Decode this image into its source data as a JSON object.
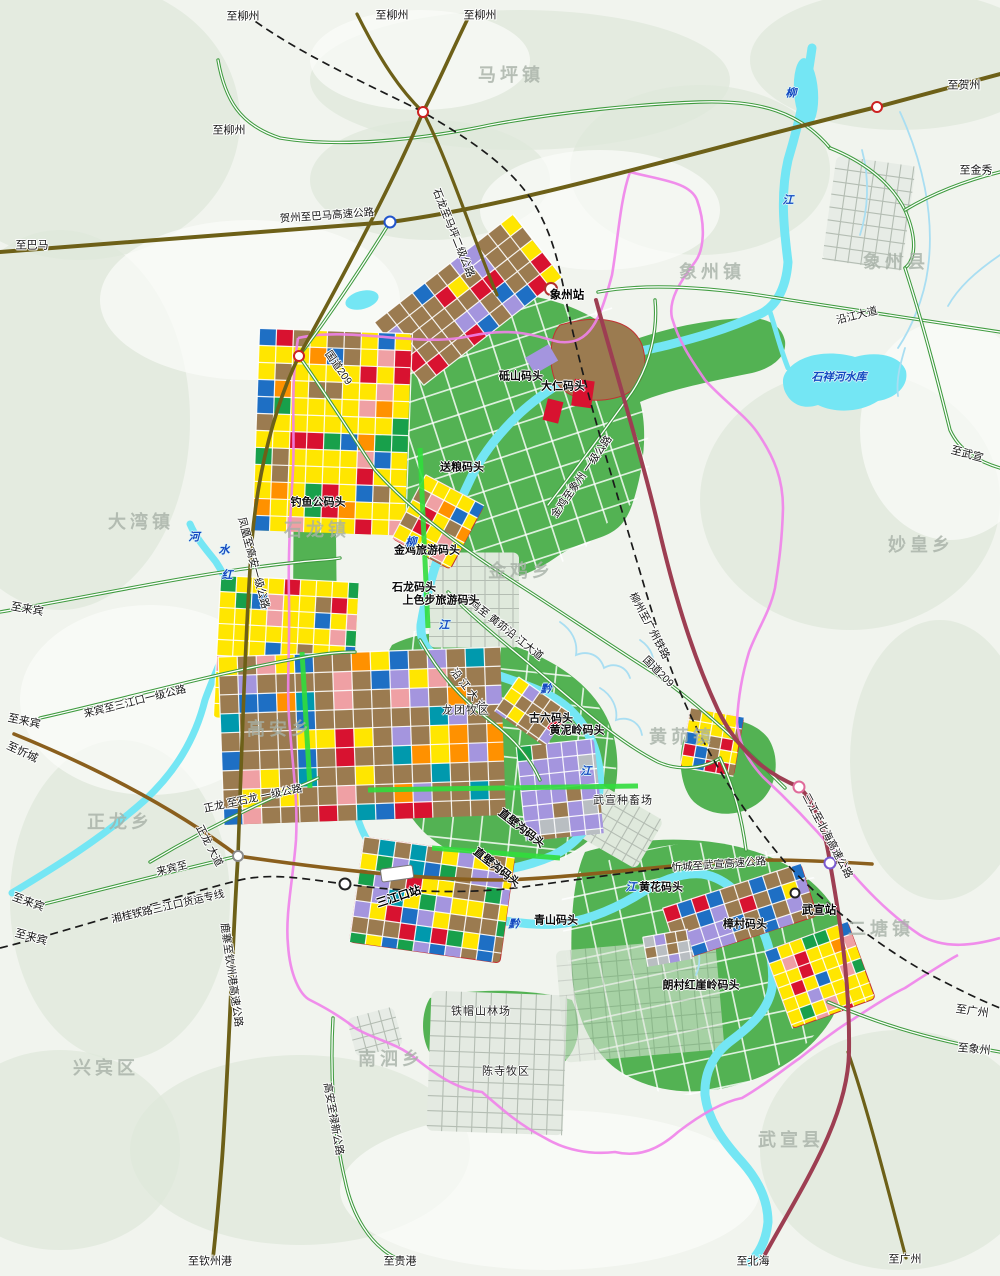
{
  "palette": {
    "background": "#f1f4ee",
    "terrain": "#dfe8db",
    "terrain_light": "#fbfcfa",
    "water": "#74e6f4",
    "water_light": "#a9def2",
    "green_zone": "#53b253",
    "bright_green": "#31dd3c",
    "road_primary": "#6d6018",
    "road_expressway": "#9d3e52",
    "road_brown": "#8a5f1d",
    "road_secondary": "#3f9b3f",
    "boundary": "#ef82ea",
    "railway": "#1a1a1a",
    "landuse": {
      "yellow": "#ffe600",
      "brown": "#9b7b50",
      "red": "#d81230",
      "pink": "#efa0a4",
      "orange": "#ff9100",
      "purple": "#a495de",
      "blue": "#1e6fc4",
      "teal": "#0099ad",
      "green": "#18a04b",
      "gray": "#b9bec2"
    }
  },
  "labels": {
    "destinations": [
      {
        "t": "至柳州",
        "x": 243,
        "y": 17,
        "r": 0
      },
      {
        "t": "至柳州",
        "x": 392,
        "y": 16,
        "r": 0
      },
      {
        "t": "至柳州",
        "x": 480,
        "y": 16,
        "r": 0
      },
      {
        "t": "至柳州",
        "x": 229,
        "y": 131,
        "r": 0
      },
      {
        "t": "至贺州",
        "x": 964,
        "y": 86,
        "r": 0
      },
      {
        "t": "至金秀",
        "x": 976,
        "y": 171,
        "r": 0
      },
      {
        "t": "至巴马",
        "x": 32,
        "y": 246,
        "r": 0
      },
      {
        "t": "至武宣",
        "x": 967,
        "y": 455,
        "r": 15
      },
      {
        "t": "至来宾",
        "x": 27,
        "y": 610,
        "r": 10
      },
      {
        "t": "至来宾",
        "x": 24,
        "y": 722,
        "r": 12
      },
      {
        "t": "至忻城",
        "x": 22,
        "y": 753,
        "r": 25
      },
      {
        "t": "至来宾",
        "x": 28,
        "y": 903,
        "r": 20
      },
      {
        "t": "至来宾",
        "x": 31,
        "y": 938,
        "r": 15
      },
      {
        "t": "至钦州港",
        "x": 210,
        "y": 1262,
        "r": 0
      },
      {
        "t": "至贵港",
        "x": 400,
        "y": 1262,
        "r": 0
      },
      {
        "t": "至北海",
        "x": 753,
        "y": 1262,
        "r": 0
      },
      {
        "t": "至广州",
        "x": 905,
        "y": 1260,
        "r": 0
      },
      {
        "t": "至广州",
        "x": 972,
        "y": 1012,
        "r": 8
      },
      {
        "t": "至象州",
        "x": 974,
        "y": 1050,
        "r": 5
      }
    ],
    "roads": [
      {
        "t": "贺州至巴马高速公路",
        "x": 327,
        "y": 216,
        "r": -4
      },
      {
        "t": "石龙至马坪二级公路",
        "x": 453,
        "y": 233,
        "r": 68
      },
      {
        "t": "国道209",
        "x": 338,
        "y": 368,
        "r": 55
      },
      {
        "t": "国道209",
        "x": 658,
        "y": 672,
        "r": 45
      },
      {
        "t": "沿江大道",
        "x": 857,
        "y": 316,
        "r": -14
      },
      {
        "t": "金鸡至象州 一级公路",
        "x": 582,
        "y": 477,
        "r": -55
      },
      {
        "t": "金鸡至 黄茆沿 江大道",
        "x": 502,
        "y": 627,
        "r": 38
      },
      {
        "t": "沿 江 大 道",
        "x": 468,
        "y": 690,
        "r": 52
      },
      {
        "t": "柳州至广州铁路",
        "x": 649,
        "y": 626,
        "r": 62
      },
      {
        "t": "凤凰至高安一级公路",
        "x": 253,
        "y": 563,
        "r": 75
      },
      {
        "t": "来宾至三江口一级公路",
        "x": 135,
        "y": 702,
        "r": -14
      },
      {
        "t": "正龙 至石龙 一级公路",
        "x": 253,
        "y": 799,
        "r": -12
      },
      {
        "t": "正龙 大道",
        "x": 209,
        "y": 846,
        "r": 62
      },
      {
        "t": "来宾至",
        "x": 172,
        "y": 869,
        "r": -14
      },
      {
        "t": "湘桂铁路三江口货运专线",
        "x": 168,
        "y": 907,
        "r": -13
      },
      {
        "t": "鹿寨至钦州港高速公路",
        "x": 231,
        "y": 975,
        "r": 82
      },
      {
        "t": "忻城至武宣高速公路",
        "x": 719,
        "y": 865,
        "r": -4
      },
      {
        "t": "三江至北海高速公路",
        "x": 827,
        "y": 836,
        "r": 62
      },
      {
        "t": "高安至禄新公路",
        "x": 333,
        "y": 1119,
        "r": 80
      }
    ],
    "stations": [
      {
        "t": "象州站",
        "x": 567,
        "y": 296,
        "r": 0
      },
      {
        "t": "三江口站",
        "x": 399,
        "y": 898,
        "r": -18
      },
      {
        "t": "武宣站",
        "x": 819,
        "y": 911,
        "r": 0
      }
    ],
    "wharves": [
      {
        "t": "砥山码头",
        "x": 521,
        "y": 377,
        "r": 0
      },
      {
        "t": "大仁码头",
        "x": 563,
        "y": 387,
        "r": 0
      },
      {
        "t": "送粮码头",
        "x": 462,
        "y": 468,
        "r": 0
      },
      {
        "t": "钓鱼公码头",
        "x": 318,
        "y": 503,
        "r": 0
      },
      {
        "t": "金鸡旅游码头",
        "x": 427,
        "y": 551,
        "r": 0
      },
      {
        "t": "石龙码头",
        "x": 414,
        "y": 588,
        "r": 0
      },
      {
        "t": "上色步旅游码头",
        "x": 441,
        "y": 601,
        "r": 0
      },
      {
        "t": "古六码头",
        "x": 551,
        "y": 719,
        "r": 0
      },
      {
        "t": "黄泥岭码头",
        "x": 577,
        "y": 731,
        "r": 0
      },
      {
        "t": "直壁沟码头",
        "x": 521,
        "y": 829,
        "r": 38
      },
      {
        "t": "直壁沟码头",
        "x": 496,
        "y": 868,
        "r": 38
      },
      {
        "t": "青山码头",
        "x": 556,
        "y": 921,
        "r": 0
      },
      {
        "t": "黄花码头",
        "x": 661,
        "y": 888,
        "r": 0
      },
      {
        "t": "樟村码头",
        "x": 745,
        "y": 925,
        "r": 0
      },
      {
        "t": "朗村红崖岭码头",
        "x": 701,
        "y": 986,
        "r": 0
      }
    ],
    "facilities": [
      {
        "t": "龙团牧区",
        "x": 466,
        "y": 711,
        "r": 0
      },
      {
        "t": "武宣种畜场",
        "x": 623,
        "y": 801,
        "r": 0
      },
      {
        "t": "铁帽山林场",
        "x": 481,
        "y": 1012,
        "r": 0
      },
      {
        "t": "陈寺牧区",
        "x": 506,
        "y": 1072,
        "r": 0
      }
    ],
    "regions": [
      {
        "t": "马坪镇",
        "x": 511,
        "y": 75,
        "r": 0
      },
      {
        "t": "象州县",
        "x": 896,
        "y": 262,
        "r": 0
      },
      {
        "t": "象州镇",
        "x": 712,
        "y": 272,
        "r": 0
      },
      {
        "t": "大湾镇",
        "x": 141,
        "y": 522,
        "r": 0
      },
      {
        "t": "石龙镇",
        "x": 317,
        "y": 530,
        "r": 0
      },
      {
        "t": "妙皇乡",
        "x": 921,
        "y": 545,
        "r": 0
      },
      {
        "t": "金鸡乡",
        "x": 521,
        "y": 571,
        "r": 0
      },
      {
        "t": "高安乡",
        "x": 280,
        "y": 729,
        "r": 0
      },
      {
        "t": "黄茆镇",
        "x": 682,
        "y": 737,
        "r": 0
      },
      {
        "t": "正龙乡",
        "x": 120,
        "y": 822,
        "r": 0
      },
      {
        "t": "二塘镇",
        "x": 881,
        "y": 929,
        "r": 0
      },
      {
        "t": "南泗乡",
        "x": 391,
        "y": 1059,
        "r": 0
      },
      {
        "t": "兴宾区",
        "x": 106,
        "y": 1068,
        "r": 0
      },
      {
        "t": "武宣县",
        "x": 791,
        "y": 1140,
        "r": 0
      }
    ],
    "rivers": [
      {
        "t": "柳",
        "x": 791,
        "y": 94,
        "r": 0
      },
      {
        "t": "江",
        "x": 788,
        "y": 201,
        "r": 0
      },
      {
        "t": "柳",
        "x": 411,
        "y": 543,
        "r": 0
      },
      {
        "t": "江",
        "x": 444,
        "y": 626,
        "r": 0
      },
      {
        "t": "河",
        "x": 194,
        "y": 538,
        "r": 0
      },
      {
        "t": "水",
        "x": 224,
        "y": 551,
        "r": 0
      },
      {
        "t": "红",
        "x": 227,
        "y": 576,
        "r": 0
      },
      {
        "t": "黔",
        "x": 546,
        "y": 690,
        "r": 0
      },
      {
        "t": "江",
        "x": 586,
        "y": 772,
        "r": 0
      },
      {
        "t": "黔",
        "x": 514,
        "y": 925,
        "r": 0
      },
      {
        "t": "江",
        "x": 631,
        "y": 888,
        "r": 0
      },
      {
        "t": "石祥河水库",
        "x": 839,
        "y": 378,
        "r": 0
      }
    ]
  }
}
